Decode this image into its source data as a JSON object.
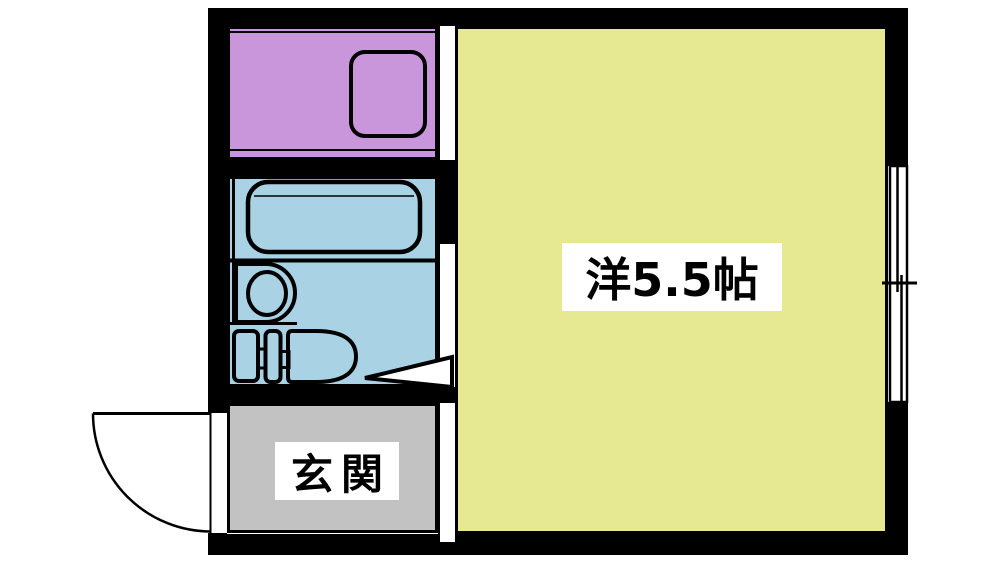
{
  "colors": {
    "background": "#ffffff",
    "wall": "#000000",
    "fixture_line": "#000000",
    "opening_fill": "#ffffff",
    "kitchen": "#c996dc",
    "bathroom": "#a9d3e5",
    "entrance": "#c2c2c2",
    "main_room": "#e6e892",
    "label_bg": "#ffffff",
    "label_text": "#000000"
  },
  "labels": {
    "main_room": "洋5.5帖",
    "entrance": "玄関"
  },
  "fixtures": [
    "kitchen-sink",
    "bathtub",
    "washbasin",
    "toilet",
    "bathroom-door-arrow",
    "entrance-door-swing",
    "sliding-window"
  ]
}
